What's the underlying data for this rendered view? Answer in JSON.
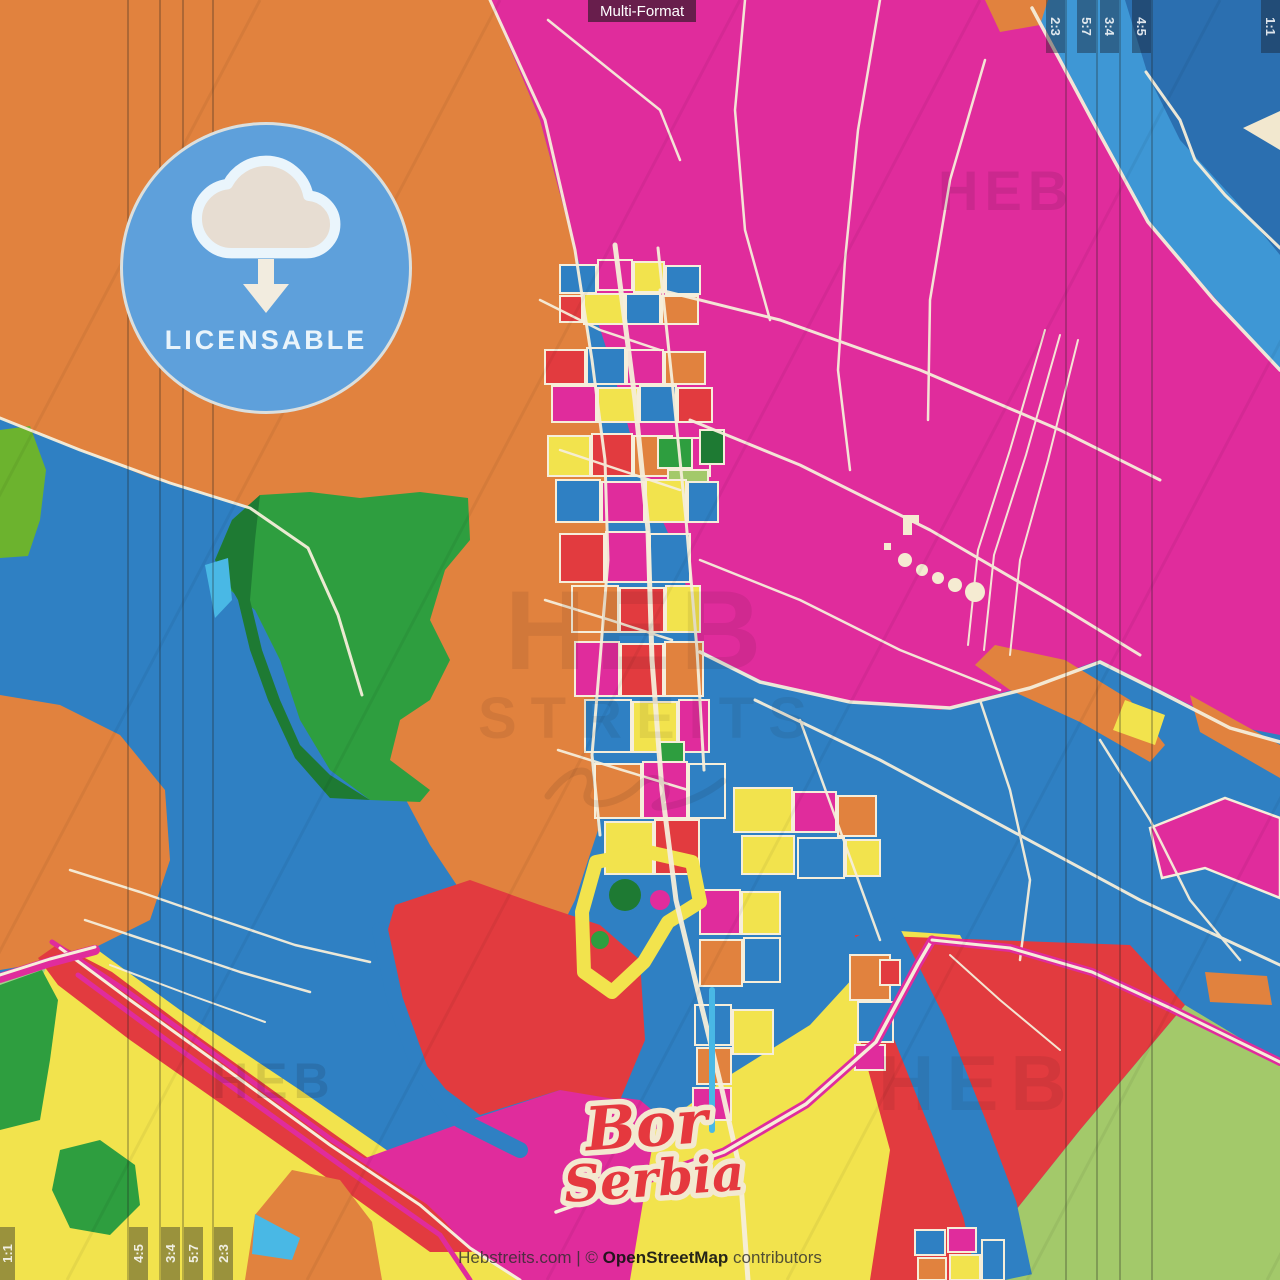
{
  "poster": {
    "title_chip": "Multi-Format",
    "place_line1": "Bor",
    "place_line2": "Serbia",
    "license_badge_label": "LICENSABLE",
    "ratios_top_right": [
      "2:3",
      "5:7",
      "3:4",
      "4:5",
      "1:1"
    ],
    "ratios_bottom_left": [
      "1:1",
      "4:5",
      "3:4",
      "5:7",
      "2:3"
    ],
    "watermarks": {
      "top_right": "HEB",
      "center_line1": "HEB",
      "center_line2": "STREITS",
      "bottom_left": "HEB",
      "bottom_right": "HEB"
    },
    "credit": {
      "site": "Hebstreits.com",
      "divider": "|",
      "copyright": "©",
      "osm": "OpenStreetMap",
      "suffix": "contributors"
    },
    "palette": {
      "magenta": "#E02C9C",
      "orange": "#E1823E",
      "blue": "#2F80C3",
      "light_blue": "#3E97D5",
      "dark_blue": "#2B6FB0",
      "cyan": "#49B8E5",
      "red": "#E23B3F",
      "yellow": "#F2E34D",
      "green": "#2E9E3F",
      "dark_green": "#1E7A33",
      "light_green": "#A3C96A",
      "lime": "#6CB32E",
      "cream": "#F6EEDA",
      "badge_blue": "#5EA0DB",
      "script_red": "#E5383E"
    }
  }
}
